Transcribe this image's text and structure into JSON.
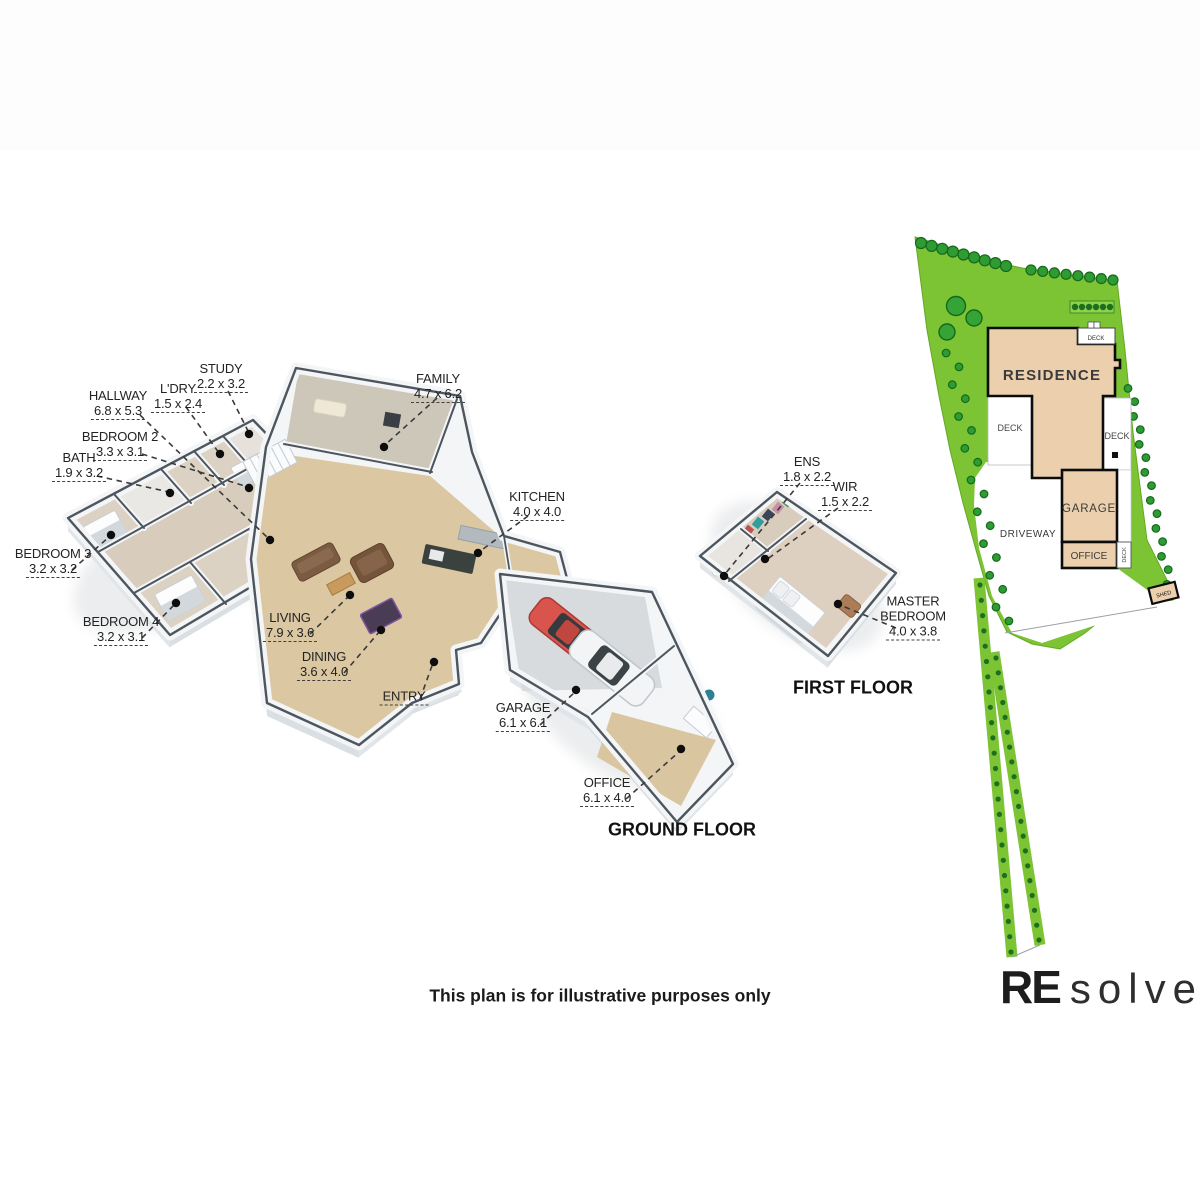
{
  "disclaimer": "This plan is for illustrative purposes only",
  "logo": {
    "re": "RE",
    "solve": "solve"
  },
  "ground_floor": {
    "title": "GROUND FLOOR",
    "rooms": [
      {
        "name": "STUDY",
        "dims": "2.2 x 3.2"
      },
      {
        "name": "L'DRY",
        "dims": "1.5 x 2.4"
      },
      {
        "name": "HALLWAY",
        "dims": "6.8 x 5.3"
      },
      {
        "name": "BEDROOM 2",
        "dims": "3.3 x 3.1"
      },
      {
        "name": "BATH",
        "dims": "1.9 x 3.2"
      },
      {
        "name": "BEDROOM 3",
        "dims": "3.2 x 3.2"
      },
      {
        "name": "BEDROOM 4",
        "dims": "3.2 x 3.1"
      },
      {
        "name": "LIVING",
        "dims": "7.9 x 3.6"
      },
      {
        "name": "DINING",
        "dims": "3.6 x 4.0"
      },
      {
        "name": "ENTRY",
        "dims": ""
      },
      {
        "name": "FAMILY",
        "dims": "4.7 x 6.2"
      },
      {
        "name": "KITCHEN",
        "dims": "4.0 x 4.0"
      },
      {
        "name": "GARAGE",
        "dims": "6.1 x 6.1"
      },
      {
        "name": "OFFICE",
        "dims": "6.1 x 4.0"
      }
    ]
  },
  "first_floor": {
    "title": "FIRST FLOOR",
    "rooms": [
      {
        "name": "ENS",
        "dims": "1.8 x 2.2"
      },
      {
        "name": "WIR",
        "dims": "1.5 x 2.2"
      },
      {
        "name": "MASTER BEDROOM",
        "dims": "4.0 x 3.8"
      }
    ]
  },
  "site_plan": {
    "residence_label": "RESIDENCE",
    "deck_label": "DECK",
    "garage_label": "GARAGE",
    "office_label": "OFFICE",
    "driveway_label": "DRIVEWAY",
    "shed_label": "SHED"
  },
  "colors": {
    "lot_green": "#7cc433",
    "tree_green": "#2f9b33",
    "building_tan": "#ecd0ae",
    "wall_dark": "#4d565e",
    "wood_floor": "#dbc8a2",
    "carpet": "#dcd2c4",
    "red_car": "#d8544c"
  }
}
